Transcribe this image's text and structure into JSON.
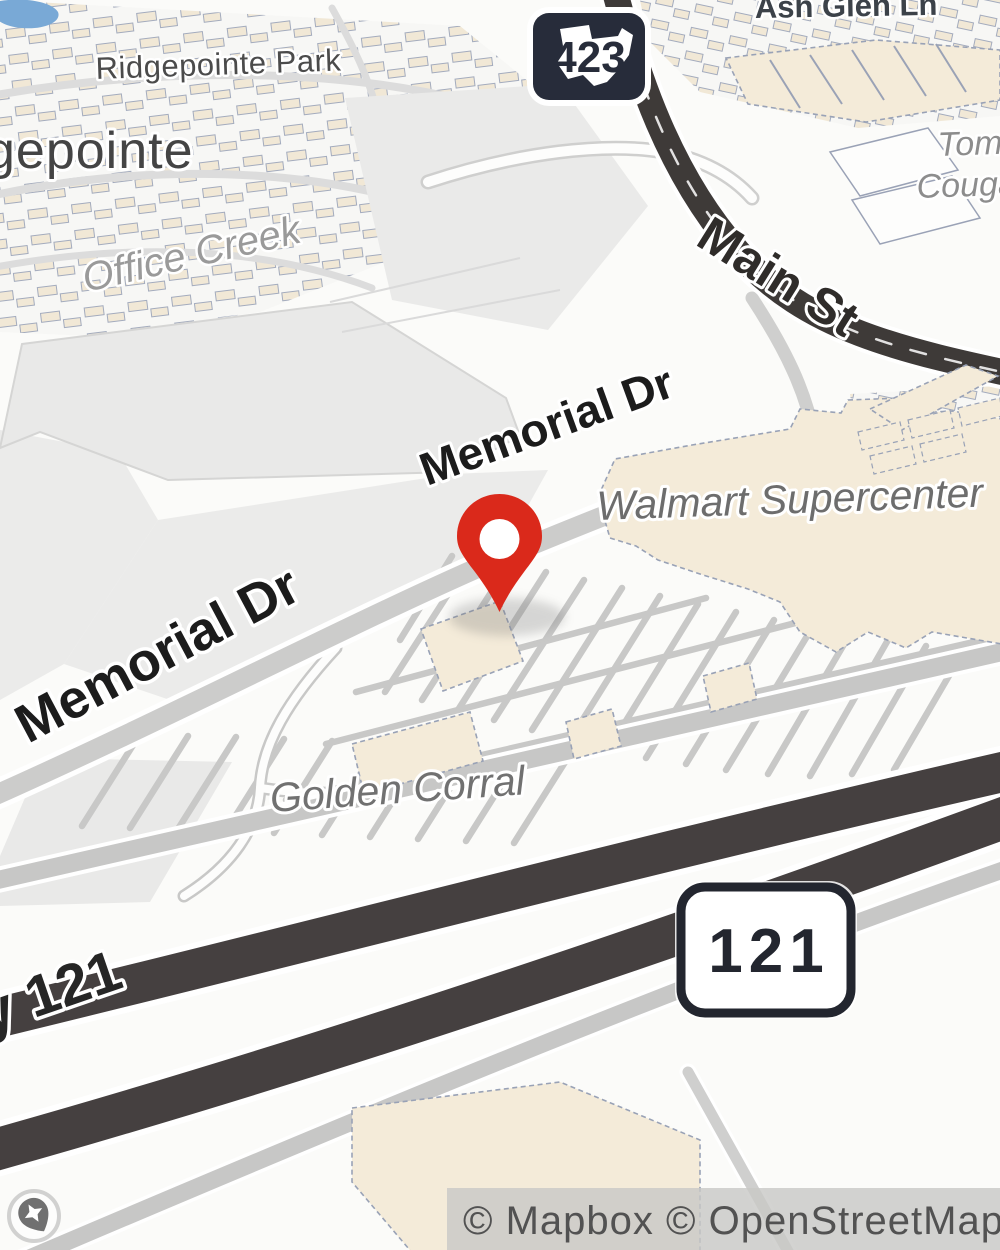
{
  "labels": {
    "ridgepointe_park": "Ridgepointe Park",
    "ridgepointe_city_partial": "gepointe",
    "office_creek": "Office Creek",
    "ash_glen_ln": "Ash Glen Ln",
    "main_st": "Main St",
    "memorial_dr_upper": "Memorial Dr",
    "memorial_dr_lower": "Memorial Dr",
    "walmart_supercenter": "Walmart Supercenter",
    "golden_corral": "Golden Corral",
    "hwy_121_partial": "y 121",
    "poi_right_partial_line1": "Tomm",
    "poi_right_partial_line2": "Couga"
  },
  "shields": {
    "route_423": "423",
    "route_121": "121"
  },
  "marker": {
    "kind": "dropped-pin",
    "color": "#da291b"
  },
  "attribution": {
    "text": "© Mapbox © OpenStreetMap"
  },
  "colors": {
    "major_road_dark": "#454040",
    "minor_road_gray": "#cbcbca",
    "building_fill": "#f4ebd9",
    "building_stroke": "#99a2b6",
    "water": "#79a9d6",
    "field_gray": "#e9e9e8",
    "shield_navy": "#272c3a",
    "poi_label_gray": "#6d6d6d"
  }
}
